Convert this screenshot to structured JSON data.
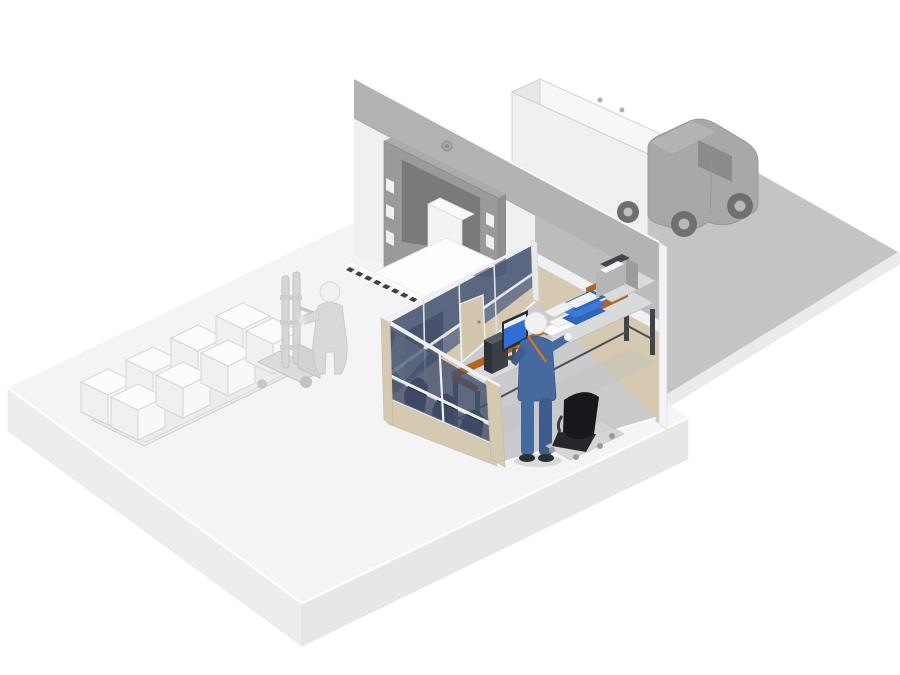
{
  "scene": {
    "name": "warehouse-loading-dock-shipping-office",
    "box_count": 8,
    "pallet_rows": 2,
    "glass_rows_per_partition": 2
  },
  "colors": {
    "background": "#ffffff",
    "road": "#c4c4c6",
    "road_edge": "#ebebed",
    "slab_top": "#f4f4f6",
    "slab_side_left": "#ededef",
    "slab_side_right": "#e7e7e9",
    "wall_face": "#f0f0f1",
    "wall_band": "#b3b3b5",
    "wall_office_gray": "#bcbcbe",
    "wall_stripe": "#f1f1f2",
    "wall_beige": "#d5c9b1",
    "wall_endcap": "#f3f3f4",
    "dock_frame": "#9a9a9c",
    "dock_frame_top": "#ababad",
    "dock_frame_side": "#8f8f91",
    "dock_opening": "#7a7a7c",
    "dock_box": "#f3f3f4",
    "dock_lamp": "#a8a8aa",
    "hazard_dark": "#3f3f41",
    "hazard_light": "#fbfbfd",
    "office_floor": "#cbcbcd",
    "partition_beige": "#d5c9b1",
    "partition_frame": "#eff0f2",
    "glass_back": "#4a5673",
    "glass_front": "#46526e",
    "office_door": "#d2c6ae",
    "desk_frame": "#b2641f",
    "desk_top": "#d9dadc",
    "desk_leg": "#3f434a",
    "pc_tower": "#3c4046",
    "monitor_screen": "#2f6fd4",
    "paper_white": "#fdfdfe",
    "tray_blue": "#2e66bd",
    "printer_gray": "#b5b5b7",
    "worker_blue": "#46699e",
    "worker_strap": "#c87a28",
    "skin_head": "#f1f1f2",
    "chair_black": "#17181c",
    "chair_plate": "#d2d2d4",
    "truck_body": "#f0f0f1",
    "truck_roof": "#f7f7f8",
    "truck_rear": "#e8e8ea",
    "truck_cab": "#a8a8aa",
    "truck_window": "#8b8b8d",
    "truck_wheel": "#6f6f71",
    "gray_figure": "#d9d9db",
    "gray_equipment": "#d6d6d8",
    "box_left": "#f0f0f2",
    "box_right": "#f8f8f9",
    "box_top": "#fcfcfd",
    "pallet_fill": "#ececee"
  }
}
